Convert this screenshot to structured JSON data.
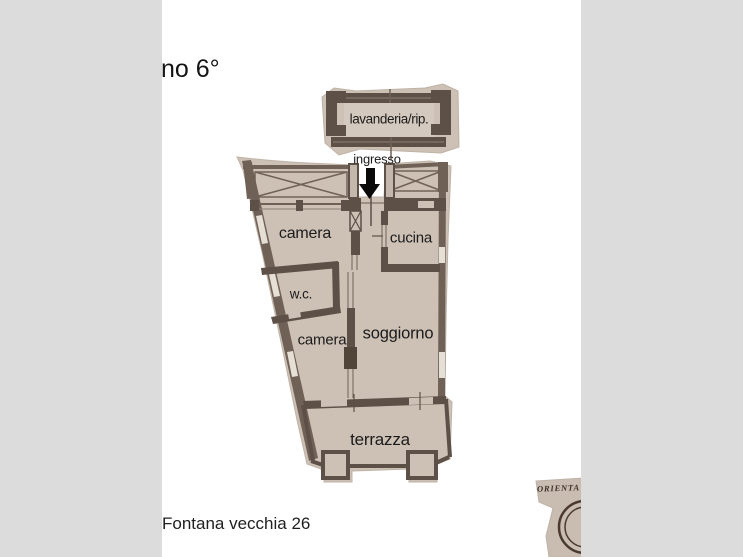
{
  "page": {
    "title": "no 6°",
    "address": "Fontana vecchia 26"
  },
  "floorplan": {
    "entrance_label": "ingresso",
    "rooms": {
      "lavanderia": "lavanderia/rip.",
      "camera1": "camera",
      "cucina": "cucina",
      "wc": "w.c.",
      "camera2": "camera",
      "soggiorno": "soggiorno",
      "terrazza": "terrazza"
    },
    "compass": "ORIENTA",
    "icons": {
      "entrance_arrow": "down-arrow-icon"
    },
    "colors": {
      "background": "#ffffff",
      "side_panel": "#dcdcdc",
      "paper": "#cdc1b6",
      "paper_light": "#d4c9be",
      "wall": "#5d5046",
      "wall_line": "#706256",
      "label_text": "#1b1b1b",
      "arrow": "#0a0a0a"
    }
  }
}
